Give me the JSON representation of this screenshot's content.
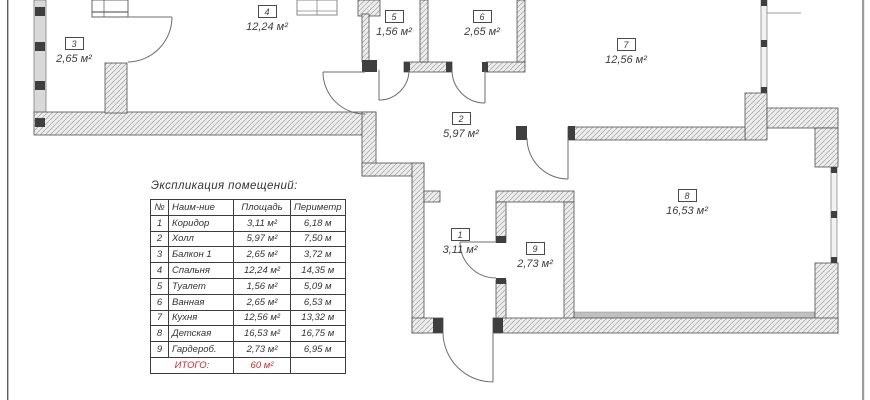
{
  "drawing": {
    "title": "Экспликация помещений:",
    "colors": {
      "accent_red": "#cc2b2b",
      "wall_outline": "#4f4f4f",
      "hatch_line": "#a0a0a0"
    },
    "rooms": [
      {
        "number": "1",
        "area": "3,11 м²"
      },
      {
        "number": "2",
        "area": "5,97 м²"
      },
      {
        "number": "3",
        "area": "2,65 м²"
      },
      {
        "number": "4",
        "area": "12,24 м²"
      },
      {
        "number": "5",
        "area": "1,56 м²"
      },
      {
        "number": "6",
        "area": "2,65 м²"
      },
      {
        "number": "7",
        "area": "12,56 м²"
      },
      {
        "number": "8",
        "area": "16,53 м²"
      },
      {
        "number": "9",
        "area": "2,73 м²"
      }
    ],
    "table": {
      "headers": [
        "№",
        "Наим-ние",
        "Площадь",
        "Периметр"
      ],
      "rows": [
        {
          "num": "1",
          "name": "Коридор",
          "area": "3,11 м²",
          "perimeter": "6,18 м"
        },
        {
          "num": "2",
          "name": "Холл",
          "area": "5,97 м²",
          "perimeter": "7,50 м"
        },
        {
          "num": "3",
          "name": "Балкон 1",
          "area": "2,65 м²",
          "perimeter": "3,72 м"
        },
        {
          "num": "4",
          "name": "Спальня",
          "area": "12,24 м²",
          "perimeter": "14,35 м"
        },
        {
          "num": "5",
          "name": "Туалет",
          "area": "1,56 м²",
          "perimeter": "5,09 м"
        },
        {
          "num": "6",
          "name": "Ванная",
          "area": "2,65 м²",
          "perimeter": "6,53 м"
        },
        {
          "num": "7",
          "name": "Кухня",
          "area": "12,56 м²",
          "perimeter": "13,32 м"
        },
        {
          "num": "8",
          "name": "Детская",
          "area": "16,53 м²",
          "perimeter": "16,75 м"
        },
        {
          "num": "9",
          "name": "Гардероб.",
          "area": "2,73 м²",
          "perimeter": "6,95 м"
        }
      ],
      "total_label": "ИТОГО:",
      "total_area": "60 м²"
    }
  }
}
